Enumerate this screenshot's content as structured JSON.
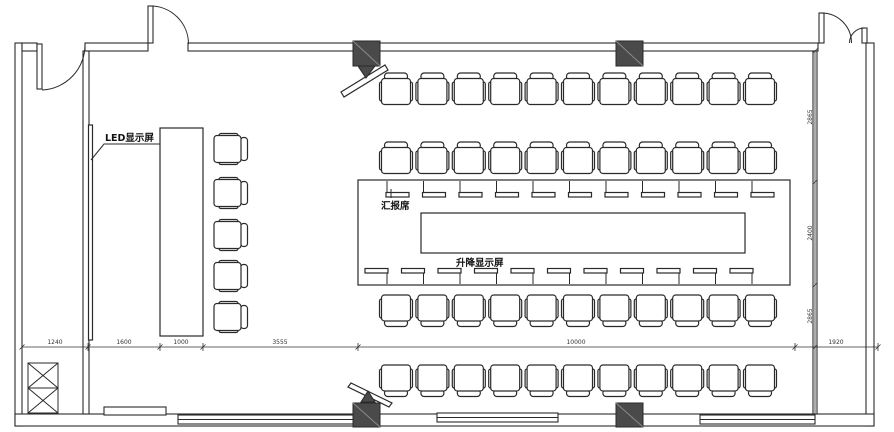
{
  "labels": {
    "led_display": "LED显示屏",
    "reporter_seat": "汇报席",
    "lifting_display": "升降显示屏"
  },
  "dimensions": {
    "bottom": [
      "1240",
      "1600",
      "1000",
      "3555",
      "10000",
      "1920"
    ],
    "right": [
      "2865",
      "2400",
      "2865"
    ]
  },
  "seating": {
    "audience_rows": 4,
    "chairs_per_row": 11,
    "side_chairs": 5,
    "table_units_top": 11,
    "table_units_bottom": 11
  },
  "colors": {
    "line": "#2a2a2a",
    "column_fill": "#4a4a4a",
    "dim_text": "#333333",
    "background": "#ffffff"
  }
}
